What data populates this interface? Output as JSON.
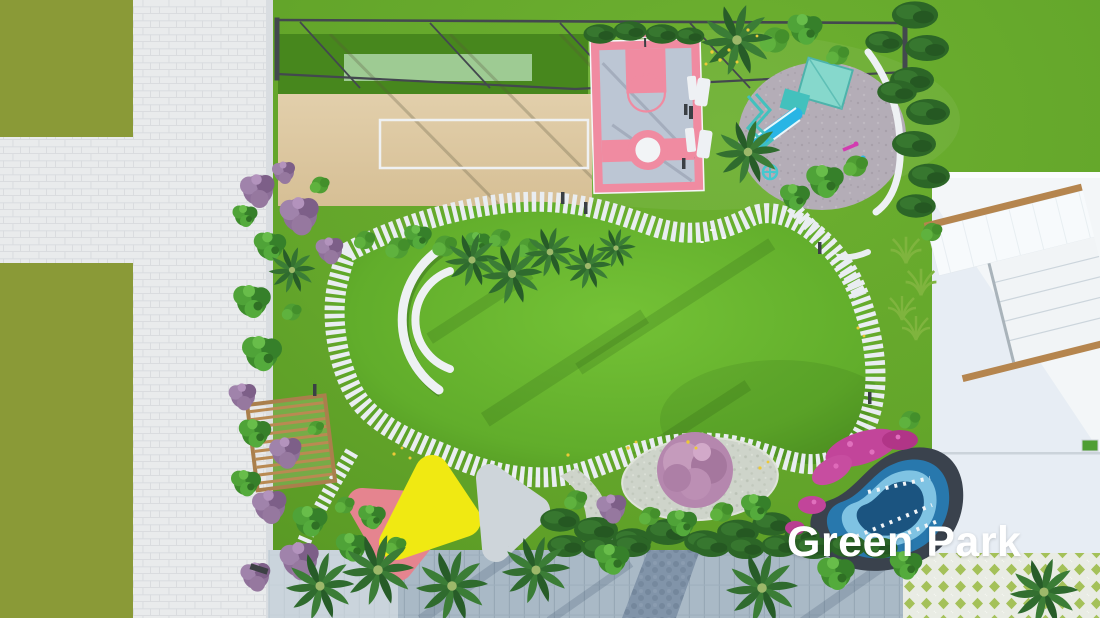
{
  "scene": {
    "watermark": "Green Park"
  },
  "palette": {
    "park_grass": "#63a52a",
    "street_grass": "#8a9a37",
    "paver_light": "#e9ebec",
    "paver_joint": "#d8dbde",
    "sand": "#dcc7a0",
    "turf": "#47871d",
    "turf_mat": "#aed7a8",
    "court_pink": "#f08ba1",
    "court_surface": "#bcc6d4",
    "playground_gray": "#b4adb7",
    "equipment_teal": "#43c1bd",
    "slide_cyan": "#28b5e5",
    "pond_rim": "#3a424d",
    "pond_mid": "#2878ad",
    "pond_light": "#7fc3e3",
    "pond_deep": "#1b5480",
    "flower_magenta": "#c2459a",
    "canopy_yellow": "#f0e912",
    "canopy_pink": "#e5848f",
    "canopy_gray": "#ced5da",
    "plaza_white": "#f3f6f8",
    "wood": "#b5854e",
    "walkway": "#a9b9c6",
    "hedge_dark": "#2c6627",
    "tree_green": "#3e8c2c",
    "tree_purple": "#8e7099",
    "path_plank": "#e9edf1",
    "lawn_light": "#74c236",
    "lawn_dark": "#4f9320",
    "text_white": "#ffffff"
  }
}
